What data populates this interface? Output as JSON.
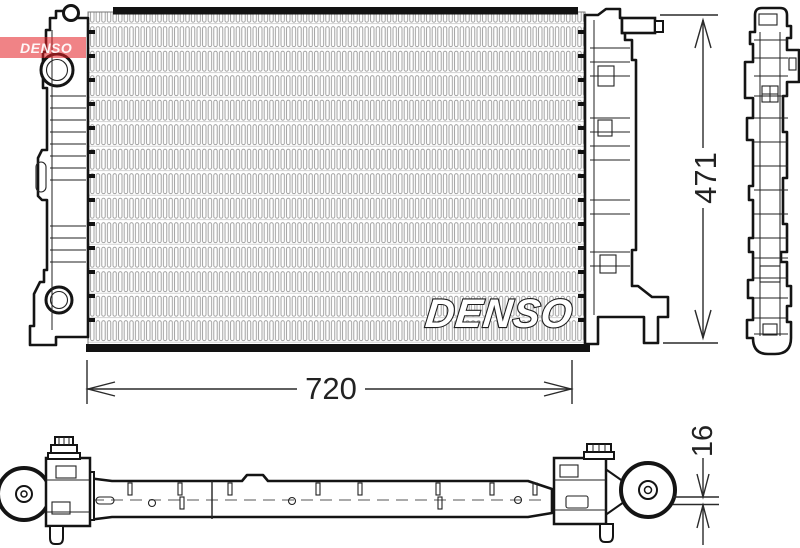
{
  "logo": {
    "text": "DENSO",
    "background_color": "#e3251f"
  },
  "watermark": {
    "text": "DENSO"
  },
  "dimensions": {
    "height": "471",
    "width": "720",
    "depth": "16"
  },
  "drawing": {
    "views": [
      "front",
      "side",
      "bottom"
    ]
  },
  "colors": {
    "line": "#1a1a1a",
    "fin_gray": "#9a9a9a",
    "dimension": "#2a2a2a"
  }
}
